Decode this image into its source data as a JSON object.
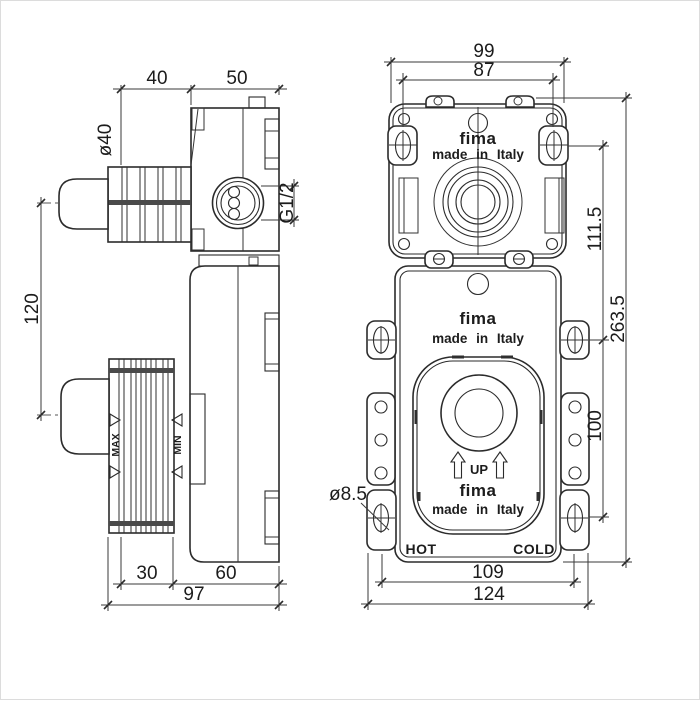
{
  "drawing": {
    "brand": "fima",
    "made_in": "made in Italy",
    "up": "UP",
    "hot": "HOT",
    "cold": "COLD",
    "max": "MAX",
    "min": "MIN"
  },
  "dims": {
    "side_view": {
      "rib_section_width": "40",
      "body_depth": "50",
      "knob_diameter": "ø40",
      "thread": "G1/2",
      "port_center_distance": "120",
      "lower_rib_width": "30",
      "lower_body_depth": "60",
      "total_depth": "97"
    },
    "front_view": {
      "upper_box_width": "99",
      "upper_slot_spacing": "87",
      "upper_to_mid_slot": "111.5",
      "total_height": "263.5",
      "mid_to_lower_slot": "100",
      "fixing_slot_diameter": "ø8.5",
      "lower_slot_spacing": "109",
      "flange_width": "124"
    }
  }
}
